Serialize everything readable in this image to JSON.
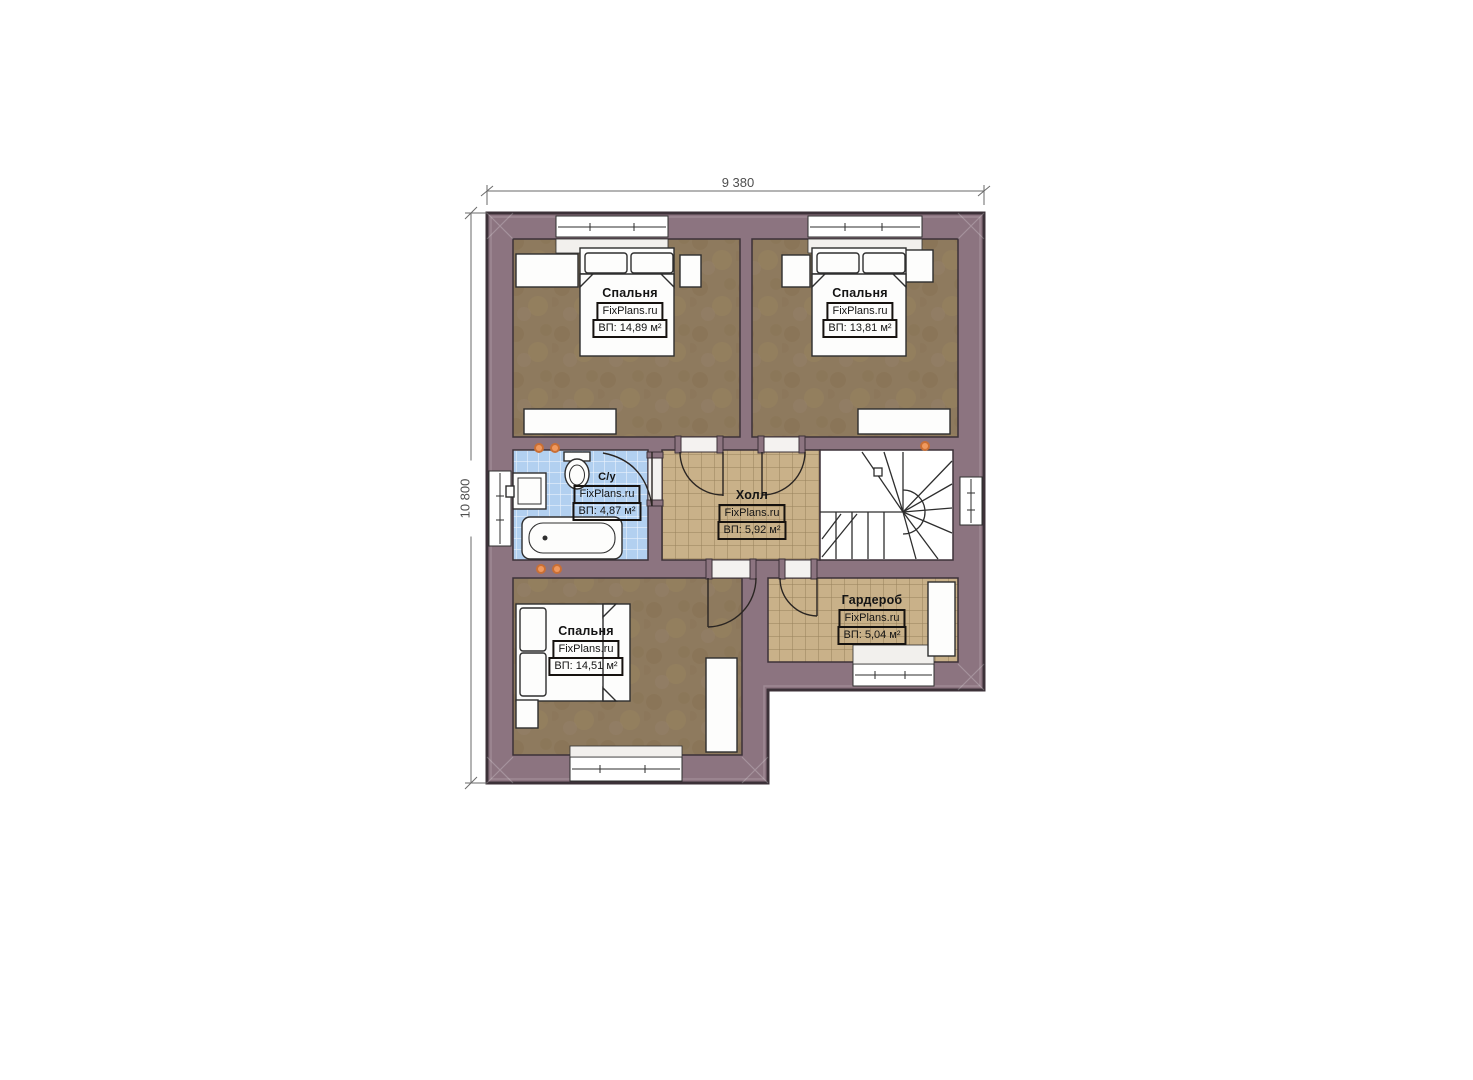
{
  "plan": {
    "title": "floor-plan-second-storey",
    "watermark": "FixPlans.ru",
    "dimensions": {
      "top": "9 380",
      "left": "10 800"
    },
    "rooms": [
      {
        "name": "Спальня",
        "area": "ВП: 14,89 м²"
      },
      {
        "name": "Спальня",
        "area": "ВП: 13,81 м²"
      },
      {
        "name": "С/у",
        "area": "ВП: 4,87 м²"
      },
      {
        "name": "Холл",
        "area": "ВП: 5,92 м²"
      },
      {
        "name": "Гардероб",
        "area": "ВП: 5,04 м²"
      },
      {
        "name": "Спальня",
        "area": "ВП: 14,51 м²"
      }
    ],
    "colors": {
      "wall": "#8c7480",
      "wall_outline": "#3c3138",
      "bedroom_floor": "#8e7a5e",
      "tile_floor": "#c9b189",
      "bathroom_tile": "#b2d0f0",
      "fixture_white": "#fdfdfc",
      "accent_dot": "#e08a4a",
      "dimension_line": "#6a6a6a"
    }
  }
}
